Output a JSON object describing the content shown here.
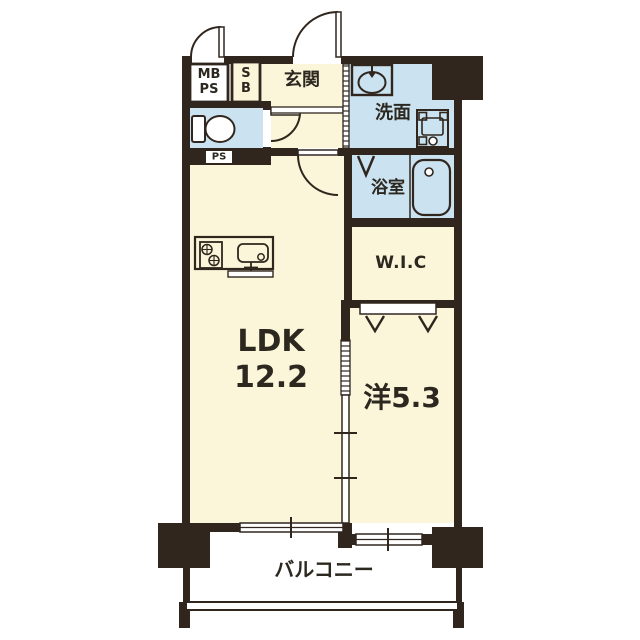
{
  "colors": {
    "wall": "#30261E",
    "floor_cream": "#FBF6D9",
    "wet_area_blue": "#CBE3F1",
    "background": "#FFFFFF",
    "text": "#2C2820"
  },
  "labels": {
    "meter_box_line1": "MB",
    "meter_box_line2": "PS",
    "shoe_box_line1": "S",
    "shoe_box_line2": "B",
    "entrance": "玄関",
    "washroom": "洗面",
    "pipe_space": "PS",
    "bathroom": "浴室",
    "walk_in_closet": "W.I.C",
    "ldk_line1": "LDK",
    "ldk_line2": "12.2",
    "western_room": "洋5.3",
    "balcony": "バルコニー"
  },
  "icons": {
    "toilet": "toilet-icon",
    "washing_machine": "washing-machine-icon",
    "vanity_sink": "vanity-sink-icon",
    "bathtub": "bathtub-icon",
    "stove": "stove-icon",
    "kitchen_sink": "kitchen-sink-icon",
    "hanger_pipes": "hanger-pipe-icon",
    "closet_shelf": "closet-shelf-icon",
    "swing_doors": "swing-door-arc-icon",
    "folding_door": "folding-door-icon",
    "sliding_doors": "sliding-door-icon",
    "windows": "sliding-window-icon",
    "railing": "balcony-railing-icon"
  }
}
